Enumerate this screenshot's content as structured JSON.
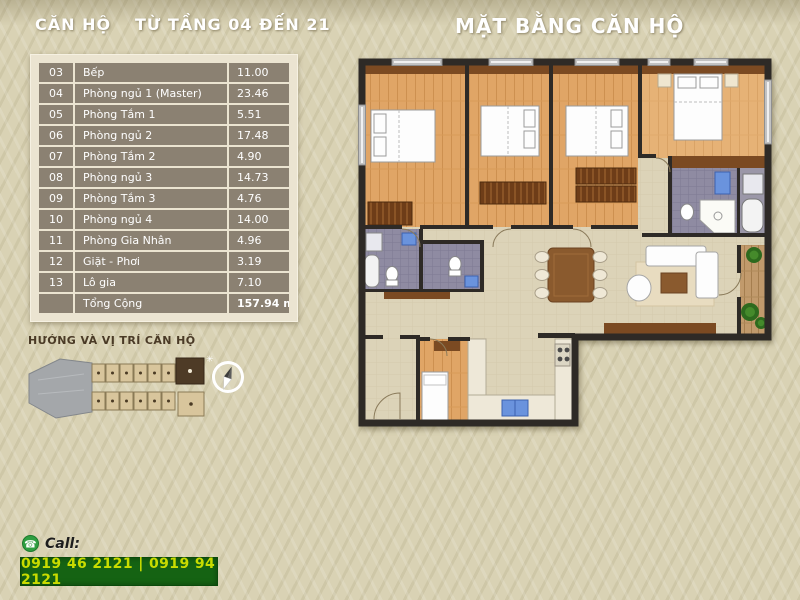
{
  "header": {
    "unit_label": "CĂN HỘ",
    "floors_label": "TỪ TẦNG 04 ĐẾN 21",
    "plan_title": "MẶT BẰNG CĂN HỘ"
  },
  "room_table": {
    "rows": [
      {
        "no": "03",
        "name": "Bếp",
        "area": "11.00"
      },
      {
        "no": "04",
        "name": "Phòng ngủ 1 (Master)",
        "area": "23.46"
      },
      {
        "no": "05",
        "name": "Phòng Tắm 1",
        "area": "5.51"
      },
      {
        "no": "06",
        "name": "Phòng ngủ 2",
        "area": "17.48"
      },
      {
        "no": "07",
        "name": "Phòng Tắm 2",
        "area": "4.90"
      },
      {
        "no": "08",
        "name": "Phòng ngủ 3",
        "area": "14.73"
      },
      {
        "no": "09",
        "name": "Phòng Tắm 3",
        "area": "4.76"
      },
      {
        "no": "10",
        "name": "Phòng ngủ 4",
        "area": "14.00"
      },
      {
        "no": "11",
        "name": "Phòng Gia Nhân",
        "area": "4.96"
      },
      {
        "no": "12",
        "name": "Giặt - Phơi",
        "area": "3.19"
      },
      {
        "no": "13",
        "name": "Lô gia",
        "area": "7.10"
      }
    ],
    "total_label": "Tổng Cộng",
    "total_area": "157.94 m²"
  },
  "location": {
    "label": "HƯỚNG VÀ VỊ TRÍ CĂN HỘ"
  },
  "contact": {
    "call_label": "Call:",
    "phones": "0919 46 2121 | 0919 94 2121"
  },
  "colors": {
    "accent_green": "#156313",
    "phone_text": "#c9dc00",
    "table_row": "#8b8172",
    "background": "#d9d2b4",
    "wall": "#2e2a26",
    "wood_floor": "#e0a566",
    "bath_tile": "#8f8ba2"
  }
}
